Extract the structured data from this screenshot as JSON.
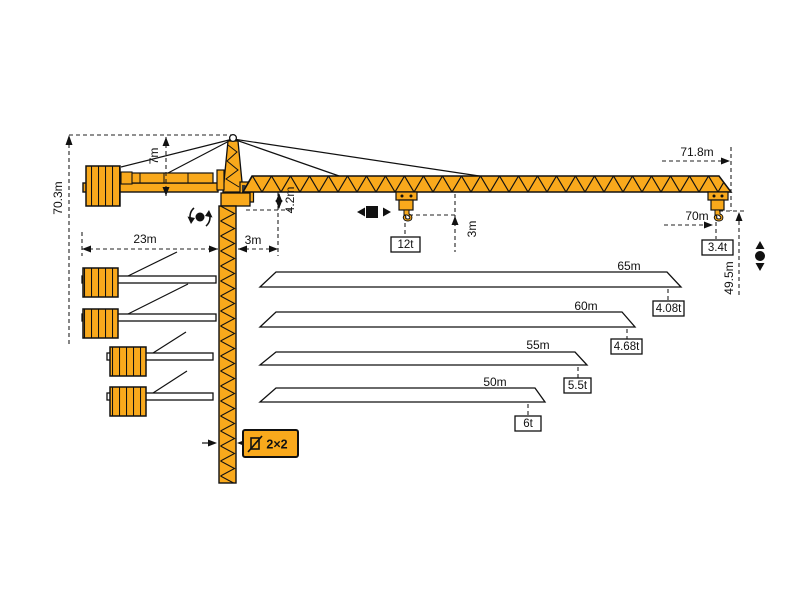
{
  "diagram": {
    "title": "tower-crane-dimension-diagram",
    "colors": {
      "crane_orange": "#F9A91C",
      "outline": "#111111",
      "dimension": "#222222",
      "background": "#ffffff"
    },
    "dimensions": {
      "total_height": "70.3m",
      "cathead_height": "7m",
      "counterjib_radius": "23m",
      "rear_offset": "3m",
      "jib_section_height": "4.2m",
      "hook_clearance": "3m",
      "max_capacity": "12t",
      "max_radius": "71.8m",
      "tip_radius": "70m",
      "tip_capacity": "3.4t",
      "hook_height": "49.5m",
      "mast_section": "2×2"
    },
    "jib_variants": [
      {
        "length": "65m",
        "tip_capacity": "4.08t"
      },
      {
        "length": "60m",
        "tip_capacity": "4.68t"
      },
      {
        "length": "55m",
        "tip_capacity": "5.5t"
      },
      {
        "length": "50m",
        "tip_capacity": "6t"
      }
    ],
    "icons": {
      "slew-icon": "rotation-arrows-around-dot",
      "trolley-travel-icon": "left-right-arrows-square",
      "hoist-icon": "up-down-arrows-dot",
      "mast-section-icon": "square-profile-with-diagonal"
    }
  }
}
